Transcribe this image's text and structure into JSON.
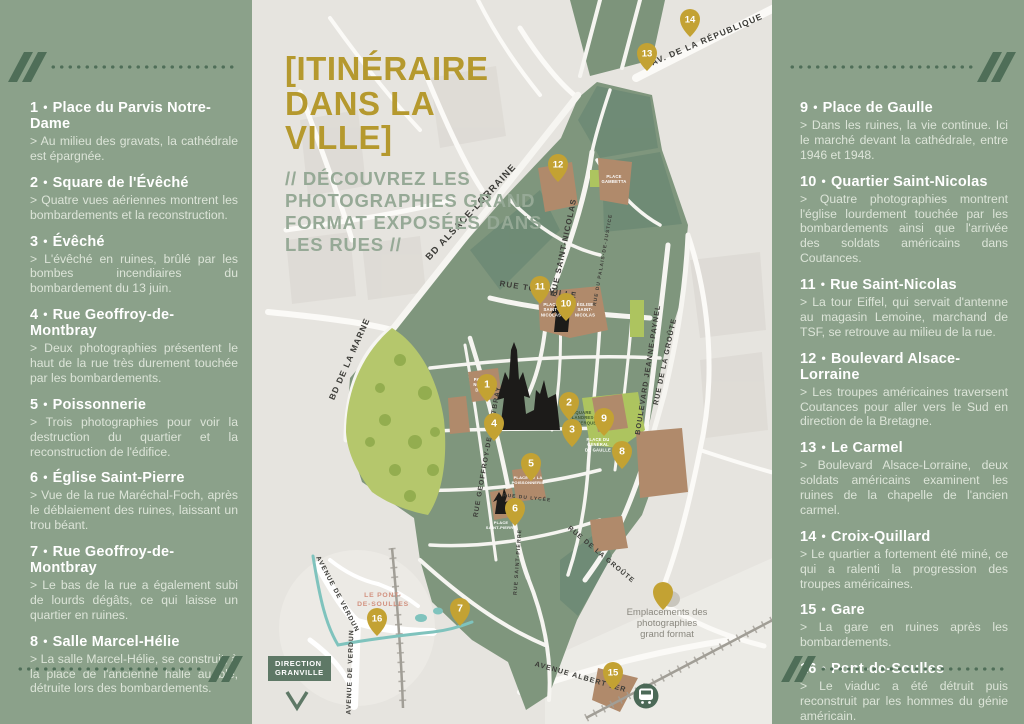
{
  "colors": {
    "panel_green": "#8ba18a",
    "accent_gold": "#b5992e",
    "subtitle_green": "#96a996",
    "pin_gold": "#c3a233",
    "map_background": "#e6e4df",
    "town_green": "#7f967d",
    "park_green": "#b5c76c",
    "place_brown": "#b08a6b",
    "river_teal": "#7fc3bd",
    "direction_bg": "#5e7866",
    "church_black": "#1c1b19"
  },
  "title": {
    "line1": "[ITINÉRAIRE",
    "line2": "DANS LA VILLE]",
    "subtitle_lines": [
      "// DÉCOUVREZ LES",
      "PHOTOGRAPHIES GRAND",
      "FORMAT EXPOSÉES DANS",
      "LES RUES //"
    ]
  },
  "left_panel": {
    "items": [
      {
        "num": "1",
        "title": "Place du Parvis Notre-Dame",
        "desc": "> Au milieu des gravats, la cathédrale est épargnée."
      },
      {
        "num": "2",
        "title": "Square de l'Évêché",
        "desc": "> Quatre vues aériennes montrent les bombardements et la reconstruction."
      },
      {
        "num": "3",
        "title": "Évêché",
        "desc": "> L'évêché en ruines, brûlé par les bombes incendiaires du bombardement du 13 juin."
      },
      {
        "num": "4",
        "title": "Rue Geoffroy-de-Montbray",
        "desc": "> Deux photographies présentent le haut de la rue très durement touchée par les bombardements."
      },
      {
        "num": "5",
        "title": "Poissonnerie",
        "desc": "> Trois photographies pour voir la destruction du quartier et la reconstruction de l'édifice."
      },
      {
        "num": "6",
        "title": "Église Saint-Pierre",
        "desc": "> Vue de la rue Maréchal-Foch, après le déblaiement des ruines, laissant un trou béant."
      },
      {
        "num": "7",
        "title": "Rue Geoffroy-de-Montbray",
        "desc": "> Le bas de la rue a également subi de lourds dégâts, ce qui laisse un quartier en ruines."
      },
      {
        "num": "8",
        "title": "Salle Marcel-Hélie",
        "desc": "> La salle Marcel-Hélie, se construit, à la place de l'ancienne halle au blé, détruite lors des bombardements."
      }
    ]
  },
  "right_panel": {
    "items": [
      {
        "num": "9",
        "title": "Place de Gaulle",
        "desc": "> Dans les ruines, la vie continue. Ici le marché devant la cathédrale, entre 1946 et 1948."
      },
      {
        "num": "10",
        "title": "Quartier Saint-Nicolas",
        "desc": "> Quatre photographies montrent l'église lourdement touchée par les bombardements ainsi que l'arrivée des soldats américains dans Coutances."
      },
      {
        "num": "11",
        "title": "Rue Saint-Nicolas",
        "desc": "> La tour Eiffel, qui servait d'antenne au magasin Lemoine, marchand de TSF, se retrouve au milieu de la rue."
      },
      {
        "num": "12",
        "title": "Boulevard Alsace-Lorraine",
        "desc": "> Les troupes américaines traversent Coutances pour aller vers le Sud en direction de la Bretagne."
      },
      {
        "num": "13",
        "title": "Le Carmel",
        "desc": "> Boulevard Alsace-Lorraine, deux soldats américains examinent les ruines de la chapelle de l'ancien carmel."
      },
      {
        "num": "14",
        "title": "Croix-Quillard",
        "desc": "> Le quartier a fortement été miné, ce qui a ralenti la progression des troupes américaines."
      },
      {
        "num": "15",
        "title": "Gare",
        "desc": "> La gare en ruines après les bombardements."
      },
      {
        "num": "16",
        "title": "Pont-de-Soulles",
        "desc": "> Le viaduc a été détruit puis reconstruit par les hommes du génie américain."
      }
    ]
  },
  "map": {
    "markers": [
      {
        "n": "1",
        "x": 487,
        "y": 386
      },
      {
        "n": "2",
        "x": 569,
        "y": 404
      },
      {
        "n": "3",
        "x": 572,
        "y": 431
      },
      {
        "n": "4",
        "x": 494,
        "y": 425
      },
      {
        "n": "5",
        "x": 531,
        "y": 465
      },
      {
        "n": "6",
        "x": 515,
        "y": 510
      },
      {
        "n": "7",
        "x": 460,
        "y": 610
      },
      {
        "n": "8",
        "x": 622,
        "y": 453
      },
      {
        "n": "9",
        "x": 604,
        "y": 420
      },
      {
        "n": "10",
        "x": 566,
        "y": 305
      },
      {
        "n": "11",
        "x": 540,
        "y": 288
      },
      {
        "n": "12",
        "x": 558,
        "y": 166
      },
      {
        "n": "13",
        "x": 647,
        "y": 55
      },
      {
        "n": "14",
        "x": 690,
        "y": 21
      },
      {
        "n": "15",
        "x": 613,
        "y": 674
      },
      {
        "n": "16",
        "x": 377,
        "y": 620
      }
    ],
    "street_labels": [
      {
        "name": "BD ALSACE-LORRAINE",
        "x": 473,
        "y": 214,
        "angle": -47,
        "size": 9.5
      },
      {
        "name": "RUE SAINT-NICOLAS",
        "x": 566,
        "y": 248,
        "angle": -78,
        "size": 8
      },
      {
        "name": "RUE TOURVILLE",
        "x": 538,
        "y": 292,
        "angle": 9,
        "size": 8
      },
      {
        "name": "RUE GEOFFROY-DE-MONTBRAY",
        "x": 489,
        "y": 452,
        "angle": -80,
        "size": 6.8
      },
      {
        "name": "BD DE LA MARNE",
        "x": 352,
        "y": 360,
        "angle": -66,
        "size": 8.5
      },
      {
        "name": "BOULEVARD JEANNE-PAYNEL",
        "x": 650,
        "y": 370,
        "angle": -81,
        "size": 7.2
      },
      {
        "name": "RUE DE LA GROÛTE",
        "x": 667,
        "y": 362,
        "angle": -78,
        "size": 7.2
      },
      {
        "name": "RUE DE LA GROÛTE",
        "x": 600,
        "y": 556,
        "angle": 40,
        "size": 6.8
      },
      {
        "name": "AV. DE LA RÉPUBLIQUE",
        "x": 708,
        "y": 42,
        "angle": -23,
        "size": 8.5
      },
      {
        "name": "AVENUE ALBERT 1ER",
        "x": 580,
        "y": 679,
        "angle": 16,
        "size": 7.2
      },
      {
        "name": "AVENUE DE VERDUN",
        "x": 336,
        "y": 595,
        "angle": 62,
        "size": 6.6
      },
      {
        "name": "AVENUE DE VERDUN",
        "x": 352,
        "y": 672,
        "angle": -88,
        "size": 6.6
      },
      {
        "name": "RUE SAINT-PIERRE",
        "x": 519,
        "y": 562,
        "angle": -86,
        "size": 5.2
      },
      {
        "name": "RUE DU LYCÉE",
        "x": 527,
        "y": 499,
        "angle": 6,
        "size": 4.8
      },
      {
        "name": "RUE DU PALAIS-DE-JUSTICE",
        "x": 604,
        "y": 260,
        "angle": -80,
        "size": 4.8
      }
    ],
    "place_labels": [
      {
        "name": "PLACE\nSAINT-\nNICOLAS",
        "x": 551,
        "y": 306,
        "size": 4.2,
        "color": "#ffffff"
      },
      {
        "name": "ÉGLISE\nSAINT-\nNICOLAS",
        "x": 585,
        "y": 306,
        "size": 4.2,
        "color": "#ffffff"
      },
      {
        "name": "PLACE\nGAMBETTA",
        "x": 614,
        "y": 178,
        "size": 4.2,
        "color": "#ffffff"
      },
      {
        "name": "PARVIS\nNOTRE-\nDAME",
        "x": 482,
        "y": 381,
        "size": 4.2,
        "color": "#ffffff"
      },
      {
        "name": "SQUARE\nFLANDRES-\nDUNKERQUE",
        "x": 582,
        "y": 414,
        "size": 4.2,
        "color": "#41592f"
      },
      {
        "name": "PLACE DU\nGÉNÉRAL\nDE GAULLE",
        "x": 598,
        "y": 441,
        "size": 4.2,
        "color": "#ffffff"
      },
      {
        "name": "PLACE DE LA\nPOISSONNERIE",
        "x": 528,
        "y": 479,
        "size": 4,
        "color": "#ffffff"
      },
      {
        "name": "PLACE\nSAINT-PIERRE",
        "x": 501,
        "y": 524,
        "size": 4,
        "color": "#ffffff"
      }
    ],
    "legend": {
      "lines": [
        "Emplacements des",
        "photographies",
        "grand format"
      ]
    },
    "inset": {
      "line1": "LE PONT-",
      "line2": "DE-SOULLES"
    },
    "direction": {
      "line1": "DIRECTION",
      "line2": "GRANVILLE"
    }
  }
}
